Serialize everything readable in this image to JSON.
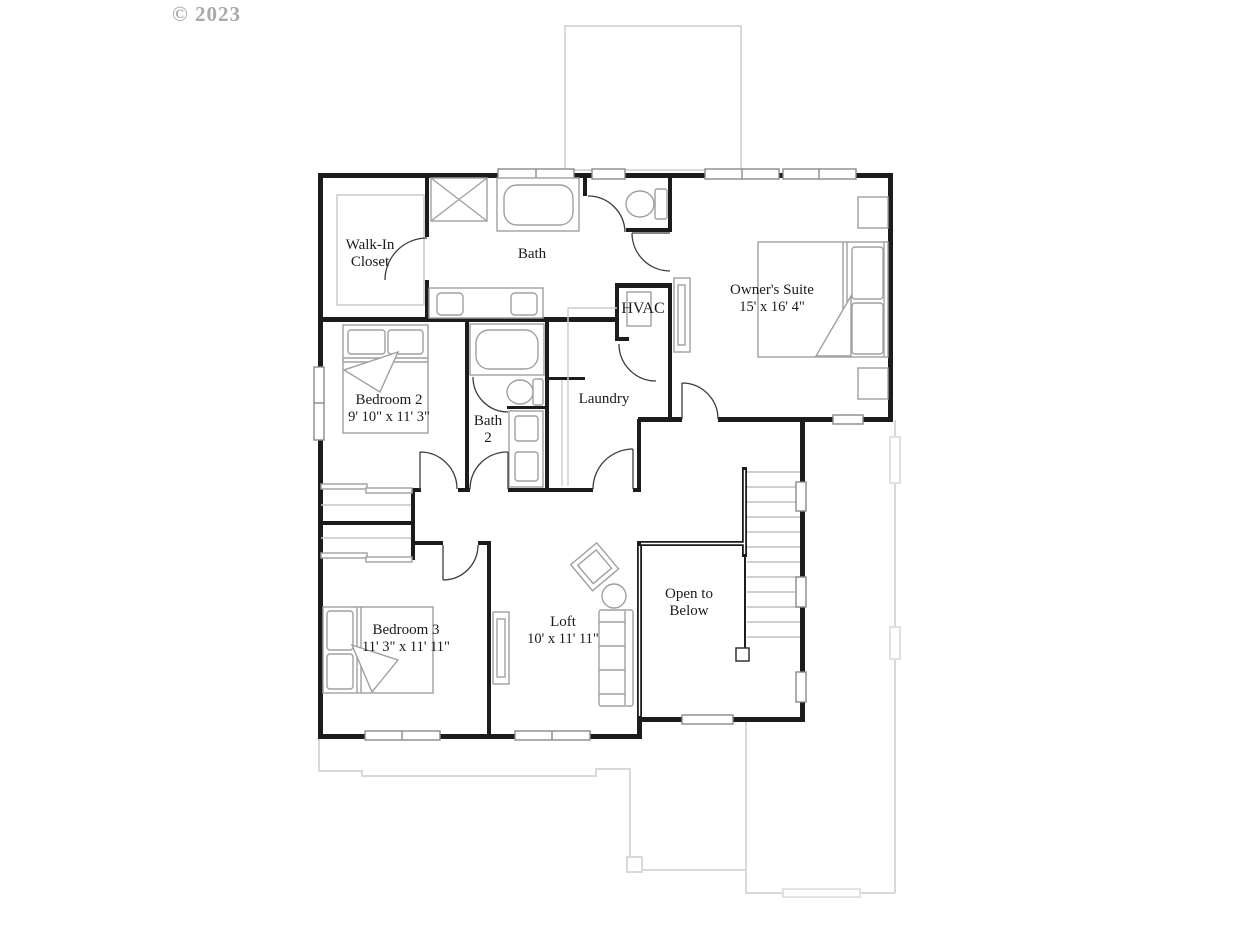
{
  "watermark": "© 2023",
  "rooms": {
    "walk_in_closet": {
      "line1": "Walk-In",
      "line2": "Closet"
    },
    "bath": {
      "label": "Bath"
    },
    "hvac": {
      "label": "HVAC"
    },
    "owners_suite": {
      "label": "Owner's Suite",
      "dims": "15' x 16' 4\""
    },
    "bedroom2": {
      "label": "Bedroom 2",
      "dims": "9' 10\" x 11' 3\""
    },
    "bath2": {
      "line1": "Bath",
      "line2": "2"
    },
    "laundry": {
      "label": "Laundry"
    },
    "bedroom3": {
      "label": "Bedroom 3",
      "dims": "11' 3\" x 11' 11\""
    },
    "loft": {
      "label": "Loft",
      "dims": "10' x 11' 11\""
    },
    "open_to_below": {
      "line1": "Open to",
      "line2": "Below"
    }
  },
  "colors": {
    "wall": "#1c1c1c",
    "fixture_outline": "#a0a0a0",
    "shelf_line": "#c6c6c6",
    "stair_tread": "#c0c0c0",
    "faint_first_floor": "#d9d9d9",
    "door_swing": "#3c3c3c",
    "label_text": "#1b1b1b",
    "watermark_text": "#aaaaaa"
  }
}
